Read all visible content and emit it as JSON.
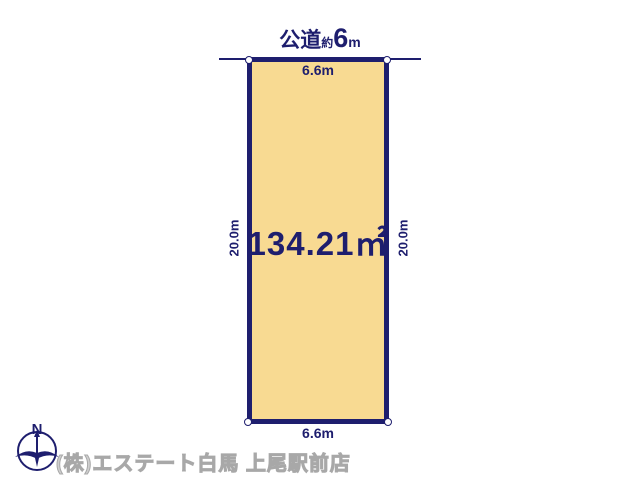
{
  "colors": {
    "page_bg": "#ffffff",
    "navy": "#1e1e6e",
    "plot_fill": "#f8da92",
    "watermark_fill": "#cfcfcf",
    "watermark_stroke": "#a8a8a8"
  },
  "road": {
    "name": "公道",
    "approx": "約",
    "value": "6",
    "unit": "m"
  },
  "plot": {
    "area_label": "134.21㎡",
    "width_top": "6.6m",
    "width_bottom": "6.6m",
    "depth_left": "20.0m",
    "depth_right": "20.0m"
  },
  "compass": {
    "north_label": "N"
  },
  "footer": {
    "company": "(株)エステート白馬 上尾駅前店"
  }
}
